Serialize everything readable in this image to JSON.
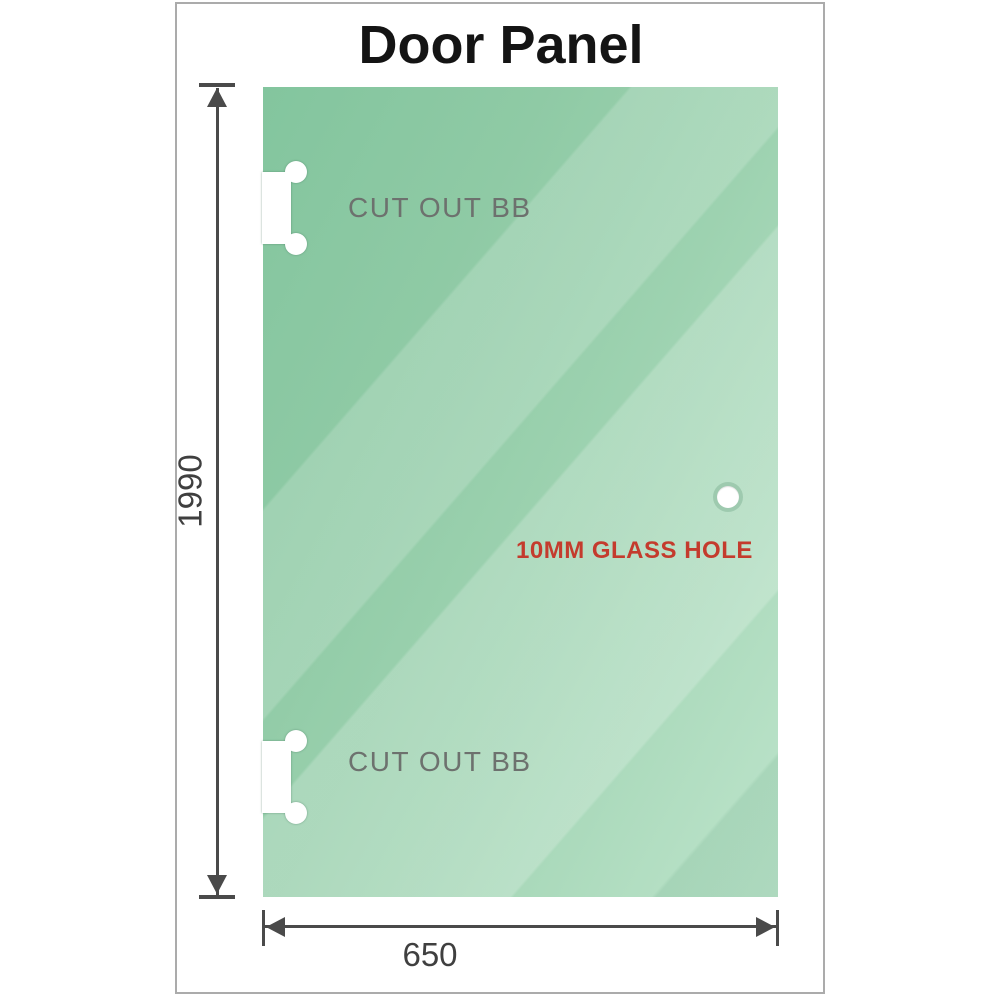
{
  "title": "Door Panel",
  "panel": {
    "cutouts": [
      {
        "label": "CUT OUT BB",
        "position": "top-left"
      },
      {
        "label": "CUT OUT BB",
        "position": "bottom-left"
      }
    ],
    "hole": {
      "label": "10MM GLASS HOLE",
      "position": "right-middle"
    }
  },
  "dimensions": {
    "height": "1990",
    "width": "650"
  },
  "colors": {
    "glass_green": "#8fcaa5",
    "glass_highlight": "#bde4cb",
    "hole_label_red": "#c43b2d",
    "dimension_gray": "#4a4a4a",
    "cutout_label_gray": "#6d716e",
    "frame_border_gray": "#ababab",
    "title_black": "#141414"
  }
}
